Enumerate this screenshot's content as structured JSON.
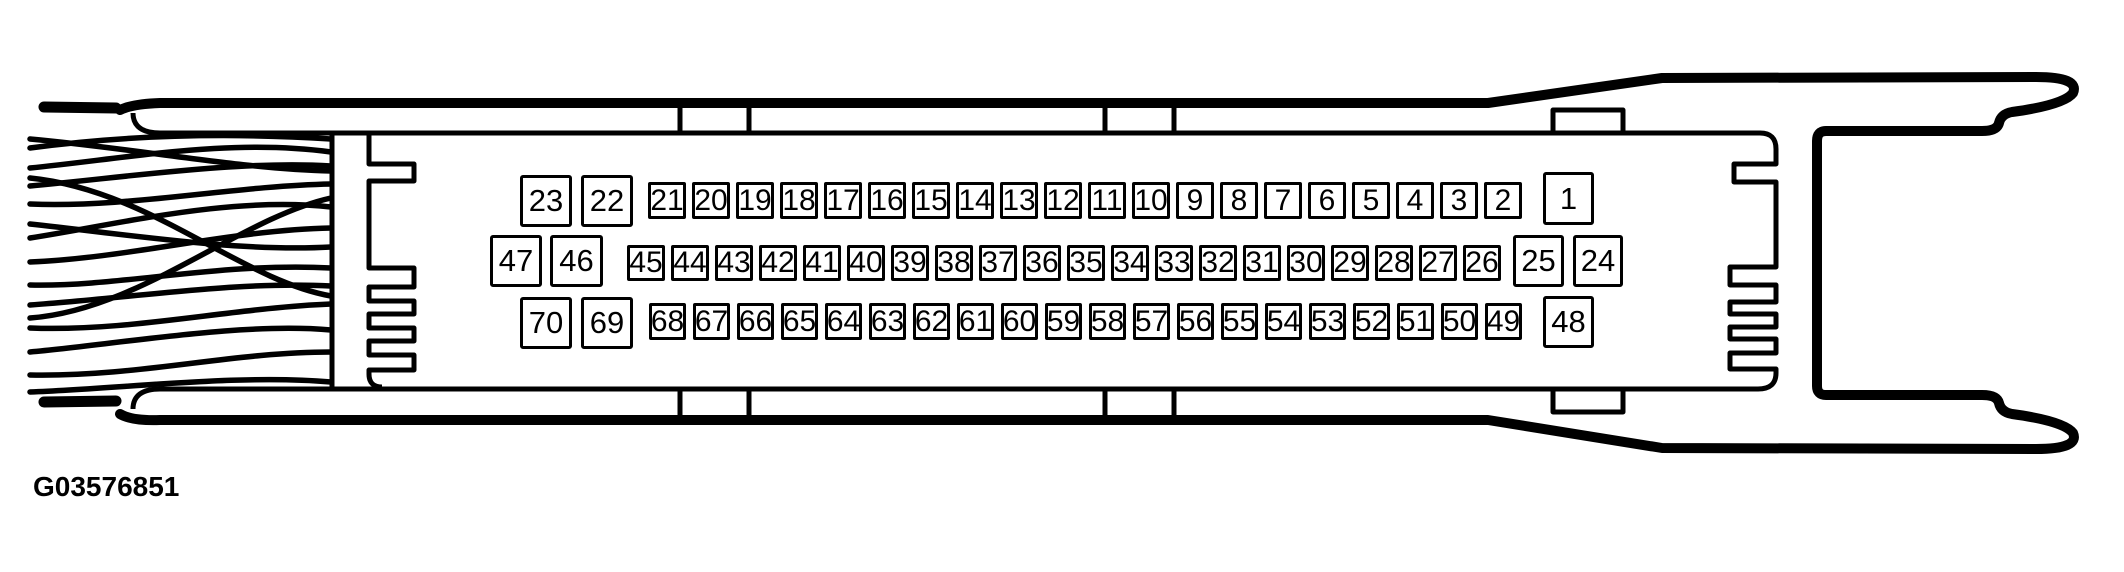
{
  "figure_label": "G03576851",
  "colors": {
    "line": "#000000",
    "background": "#ffffff"
  },
  "connector": {
    "description": "70-pin connector face view with wire harness",
    "rows": [
      {
        "left_large": [
          "23",
          "22"
        ],
        "small": [
          "21",
          "20",
          "19",
          "18",
          "17",
          "16",
          "15",
          "14",
          "13",
          "12",
          "11",
          "10",
          "9",
          "8",
          "7",
          "6",
          "5",
          "4",
          "3",
          "2"
        ],
        "right_large": [
          "1"
        ]
      },
      {
        "left_large": [
          "47",
          "46"
        ],
        "small": [
          "45",
          "44",
          "43",
          "42",
          "41",
          "40",
          "39",
          "38",
          "37",
          "36",
          "35",
          "34",
          "33",
          "32",
          "31",
          "30",
          "29",
          "28",
          "27",
          "26"
        ],
        "right_large": [
          "25",
          "24"
        ]
      },
      {
        "left_large": [
          "70",
          "69"
        ],
        "small": [
          "68",
          "67",
          "66",
          "65",
          "64",
          "63",
          "62",
          "61",
          "60",
          "59",
          "58",
          "57",
          "56",
          "55",
          "54",
          "53",
          "52",
          "51",
          "50",
          "49"
        ],
        "right_large": [
          "48"
        ]
      }
    ]
  }
}
